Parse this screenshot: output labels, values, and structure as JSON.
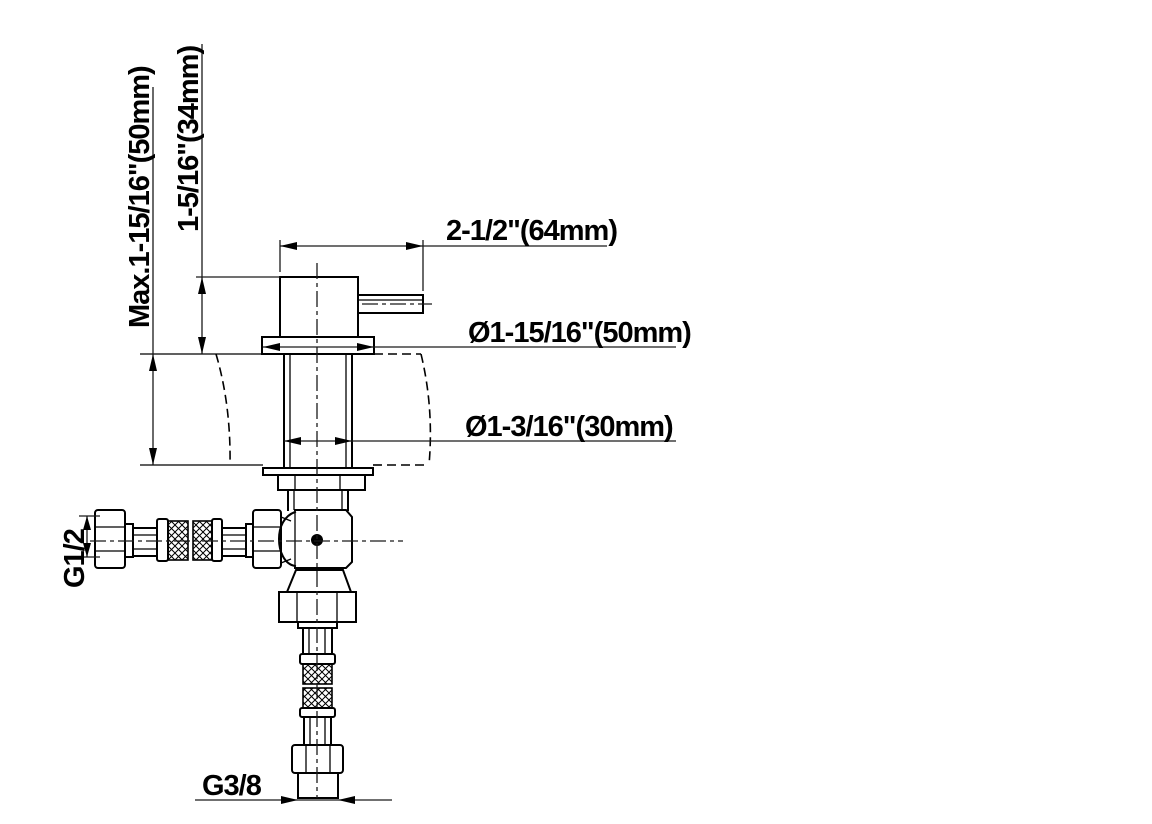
{
  "drawing": {
    "background_color": "#ffffff",
    "line_color": "#000000",
    "labels": {
      "max_deck_thickness": "Max.1-15/16\"(50mm)",
      "body_height_above_deck": "1-5/16\"(34mm)",
      "spout_length": "2-1/2\"(64mm)",
      "flange_diameter": "Ø1-15/16\"(50mm)",
      "shank_diameter": "Ø1-3/16\"(30mm)",
      "inlet_hose_thread": "G1/2",
      "supply_connection_thread": "G3/8"
    }
  }
}
